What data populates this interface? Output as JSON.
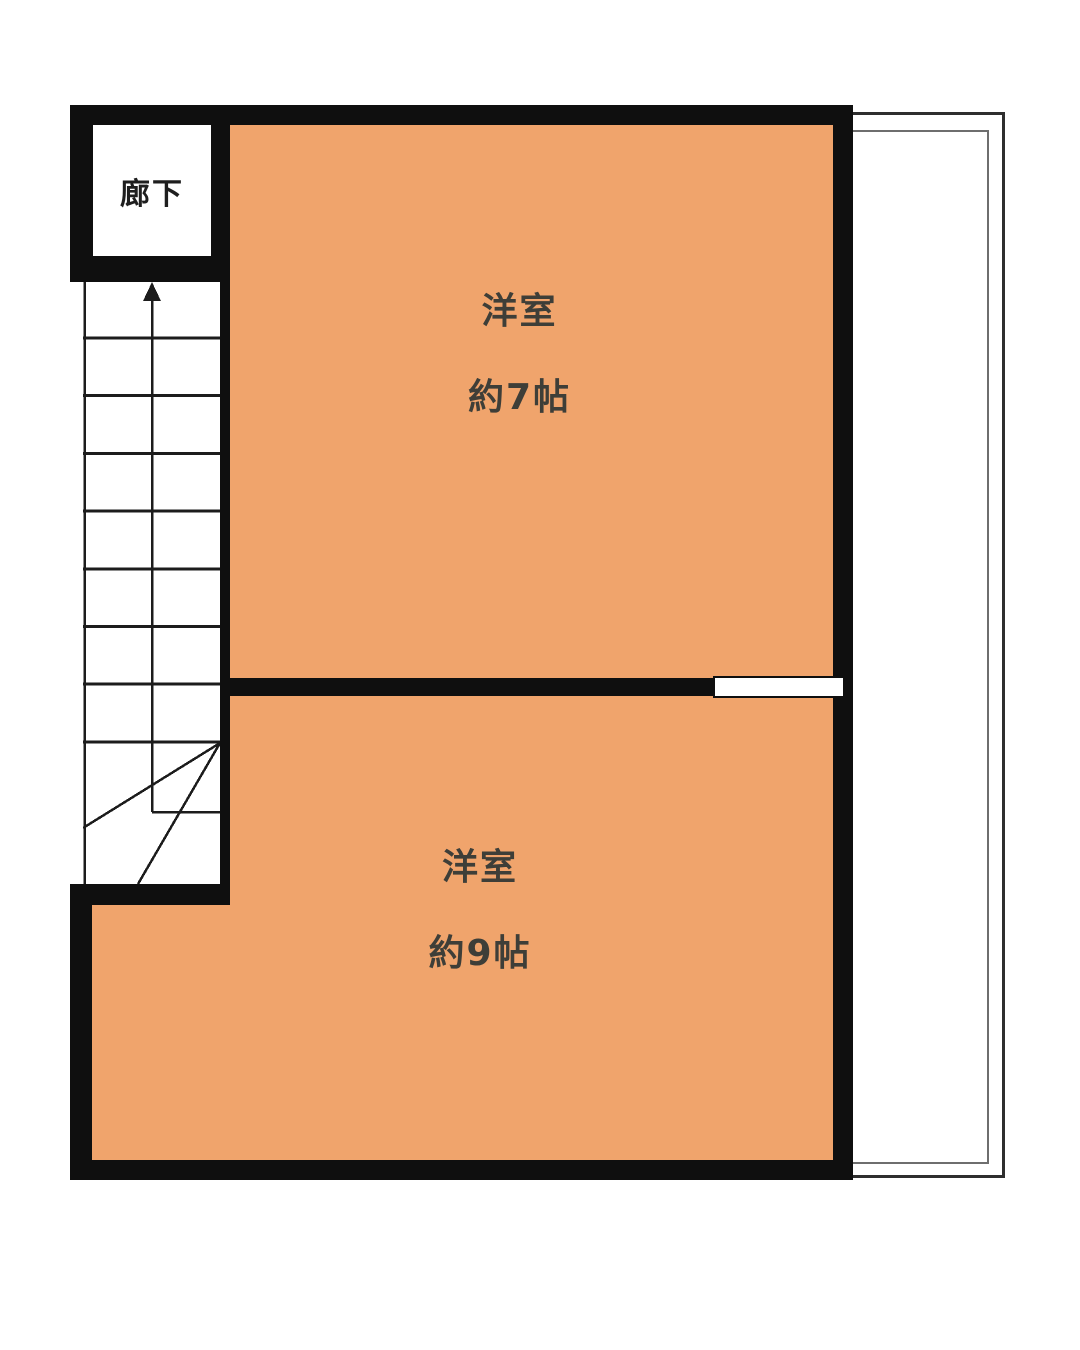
{
  "colors": {
    "room_fill": "#F0A46C",
    "wall": "#0F0F0F",
    "background": "#FFFFFF",
    "door_fill": "#FFFFFF",
    "room_label": "#3E3E38",
    "hallway_label": "#1E1E1E",
    "stair_line": "#1C1C1C",
    "balcony_outer_line": "#2E2E2E",
    "balcony_inner_line": "#6E6E6E"
  },
  "hallway": {
    "label": "廊下"
  },
  "rooms": [
    {
      "name": "洋室",
      "size": "約7帖"
    },
    {
      "name": "洋室",
      "size": "約9帖"
    }
  ],
  "stairs": {
    "tread_count": 8,
    "direction": "up",
    "arrow_icon": "up-arrow"
  }
}
